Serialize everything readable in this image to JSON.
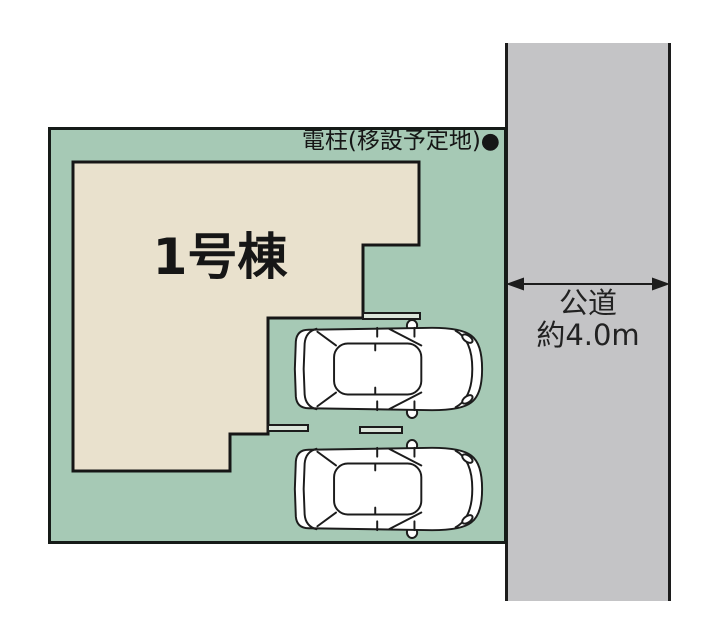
{
  "colors": {
    "background": "#FFFFFF",
    "plot_green": "#A6C9B5",
    "building_beige": "#E9E1CD",
    "road_gray": "#C4C4C6",
    "parking_marker_fill": "#DCE6DB",
    "car_fill": "#FFFFFF",
    "line_black": "#1C1C1C"
  },
  "site_plan": {
    "building": {
      "label": "1号棟"
    },
    "utility_pole": {
      "label": "電柱(移設予定地)",
      "marker": "●"
    },
    "road": {
      "name": "公道",
      "width": "約4.0m"
    }
  }
}
